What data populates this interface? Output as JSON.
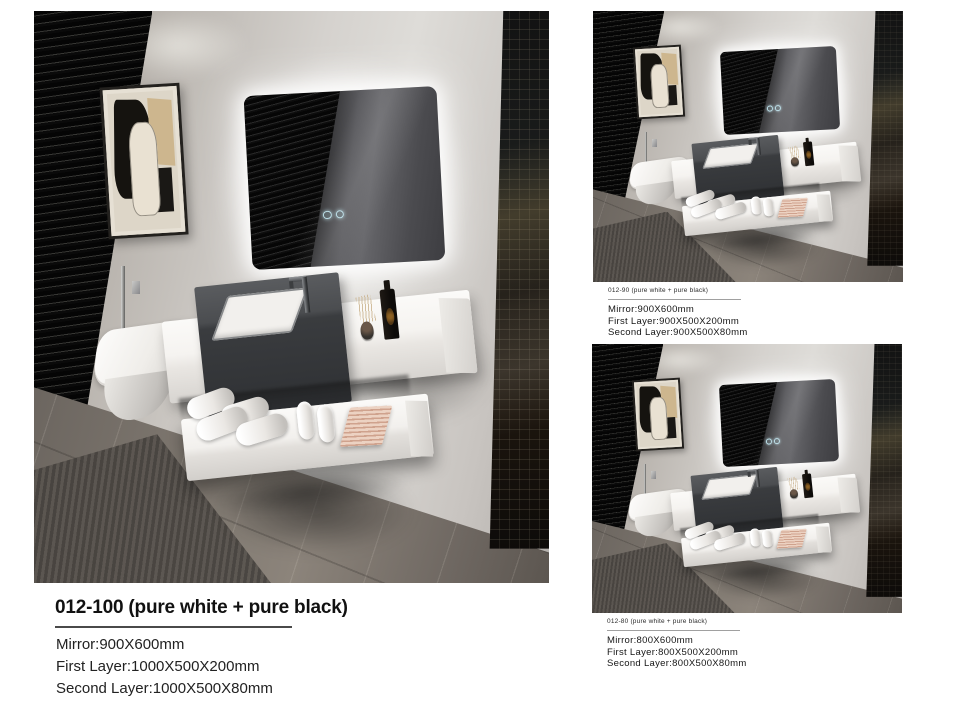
{
  "page": {
    "background": "#ffffff",
    "type": "product-spec-sheet"
  },
  "products": [
    {
      "code": "012-100",
      "title": "012-100 (pure white + pure black)",
      "specs": {
        "mirror": "Mirror:900X600mm",
        "first_layer": "First Layer:1000X500X200mm",
        "second_layer": "Second Layer:1000X500X80mm"
      }
    },
    {
      "code": "012-90",
      "title": "012-90 (pure white + pure black)",
      "specs": {
        "mirror": "Mirror:900X600mm",
        "first_layer": "First Layer:900X500X200mm",
        "second_layer": "Second Layer:900X500X80mm"
      }
    },
    {
      "code": "012-80",
      "title": "012-80 (pure white + pure black)",
      "specs": {
        "mirror": "Mirror:800X600mm",
        "first_layer": "First Layer:800X500X200mm",
        "second_layer": "Second Layer:800X500X80mm"
      }
    }
  ],
  "scene_elements": [
    "window-blinds",
    "wall-art-frame",
    "led-mirror",
    "mirror-touch-controls",
    "hand-sprayer",
    "wall-hung-toilet",
    "vanity-first-layer",
    "basin",
    "faucet",
    "dried-plant",
    "soap-bottle",
    "vanity-second-layer",
    "rolled-towels",
    "paper-rolls",
    "folded-towels",
    "rug",
    "glass-partition"
  ],
  "colors": {
    "page_background": "#ffffff",
    "wall_greige": "#d0cdc9",
    "vanity_white": "#f4f2ef",
    "basin_charcoal": "#3a3c3f",
    "floor_gray_brown": "#746d66",
    "blinds_black": "#0a0a0a",
    "led_glow": "#ffffff",
    "towel_pink": "#d8ab9c",
    "title_text": "#111111",
    "spec_text": "#222222"
  }
}
